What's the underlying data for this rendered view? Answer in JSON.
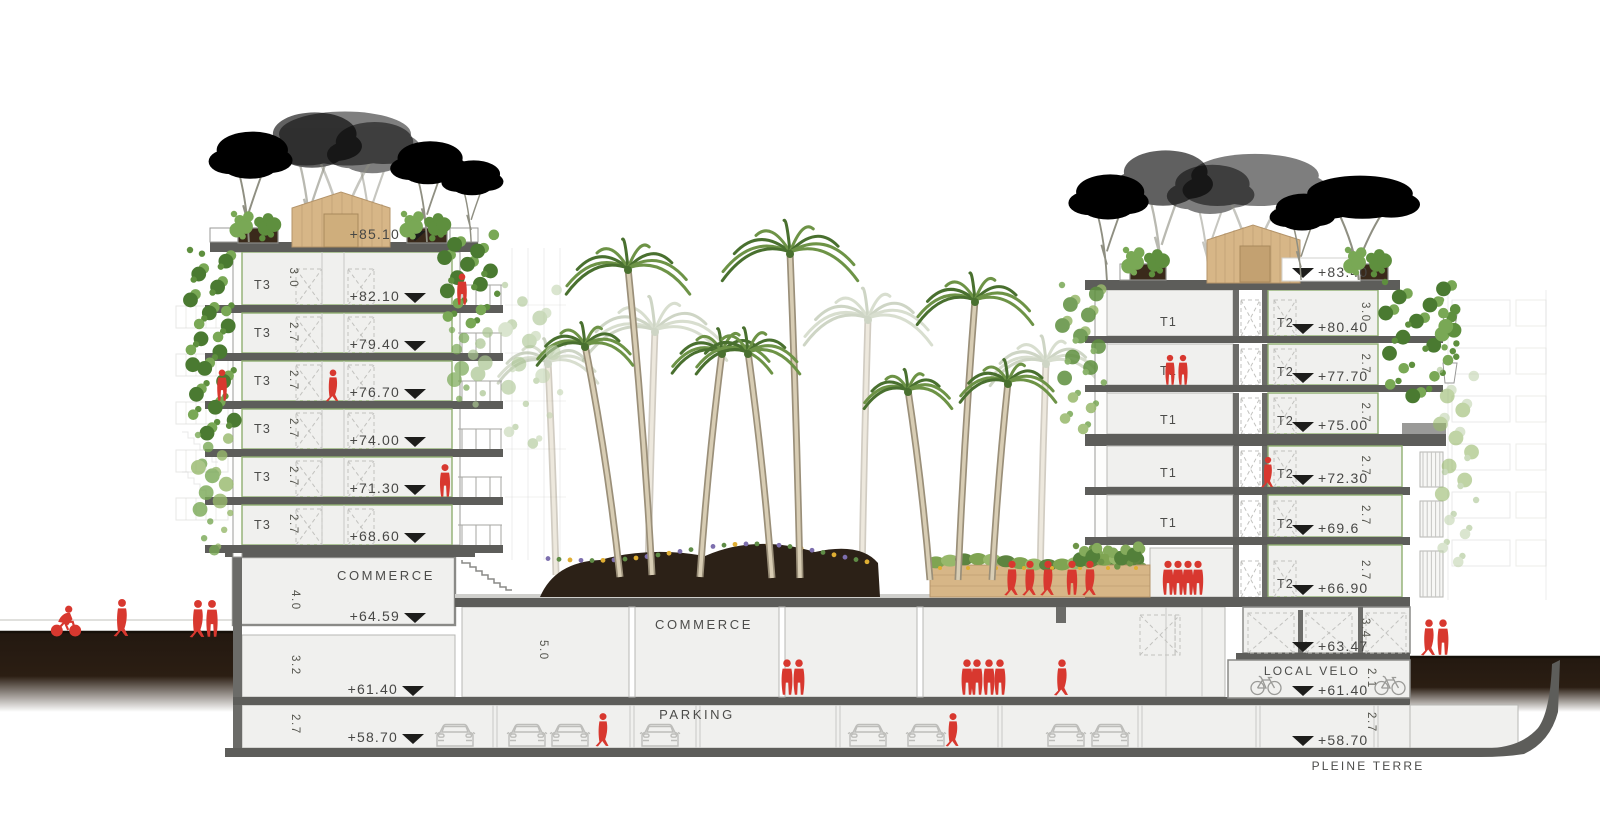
{
  "left_building": {
    "roof_elevation": "+85.10",
    "floors": [
      {
        "unit": "T3",
        "height": "3.0",
        "elevation": "+82.10"
      },
      {
        "unit": "T3",
        "height": "2.7",
        "elevation": "+79.40"
      },
      {
        "unit": "T3",
        "height": "2.7",
        "elevation": "+76.70"
      },
      {
        "unit": "T3",
        "height": "2.7",
        "elevation": "+74.00"
      },
      {
        "unit": "T3",
        "height": "2.7",
        "elevation": "+71.30"
      },
      {
        "unit": "T3",
        "height": "2.7",
        "elevation": "+68.60"
      }
    ],
    "commerce": {
      "label": "COMMERCE",
      "height": "4.0",
      "elevation": "+64.59"
    },
    "basements": [
      {
        "height": "3.2",
        "elevation": "+61.40"
      },
      {
        "height": "2.7",
        "elevation": "+58.70"
      }
    ]
  },
  "plaza": {
    "commerce_label": "COMMERCE",
    "commerce_height": "5.0",
    "parking_label": "PARKING"
  },
  "right_building": {
    "roof_elevation": "+83.40",
    "floors": [
      {
        "unit_left": "T1",
        "unit_right": "T2",
        "height": "3.0",
        "elevation": "+80.40"
      },
      {
        "unit_left": "T1",
        "unit_right": "T2",
        "height": "2.7",
        "elevation": "+77.70"
      },
      {
        "unit_left": "T1",
        "unit_right": "T2",
        "height": "2.7",
        "elevation": "+75.00"
      },
      {
        "unit_left": "T1",
        "unit_right": "T2",
        "height": "2.7",
        "elevation": "+72.30"
      },
      {
        "unit_left": "T1",
        "unit_right": "T2",
        "height": "2.7",
        "elevation": "+69.6"
      },
      {
        "unit_left": "",
        "unit_right": "T2",
        "height": "2.7",
        "elevation": "+66.90"
      }
    ],
    "garage": {
      "height": "3.4",
      "elevation": "+63.47"
    },
    "bike_room": {
      "label": "LOCAL VELO",
      "height": "2.1",
      "elevation": "+61.40"
    },
    "lower": {
      "height": "2.7",
      "elevation": "+58.70"
    }
  },
  "ground": {
    "label": "PLEINE TERRE"
  },
  "colors": {
    "accent_red": "#d8382f",
    "slab_gray": "#5d5d5a",
    "floor_green_outline": "#8faf70",
    "soil_brown": "#241810",
    "wood": "#d7b687",
    "pine_green": "#4d7c39",
    "palm_green": "#6d9346"
  }
}
